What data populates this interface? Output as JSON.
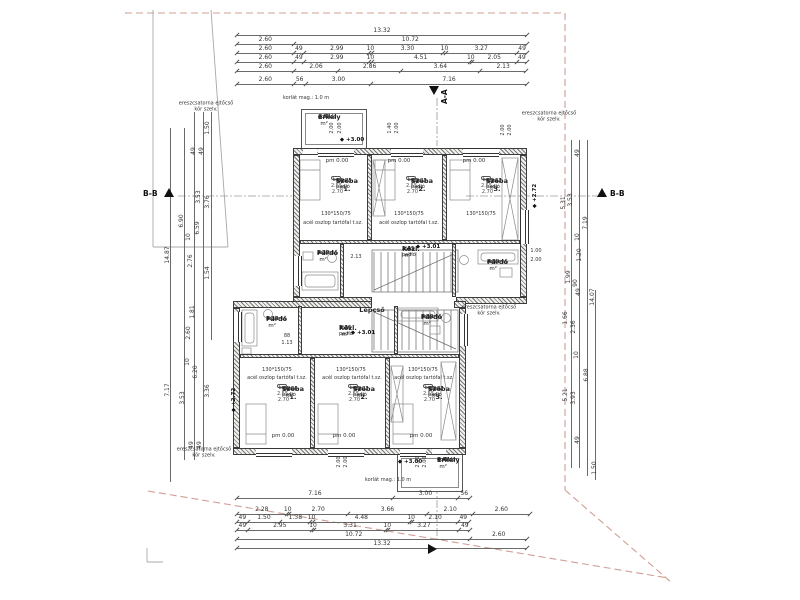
{
  "drawing": {
    "scale_px_per_m": 21.77,
    "line_color": "#555555",
    "boundary_color": "#cf9f94",
    "hatch_color": "#787878"
  },
  "sections": {
    "top": "A-A",
    "left": "B-B",
    "right": "B-B"
  },
  "stair_label": {
    "x": 372,
    "y": 310,
    "t": "Lépcső"
  },
  "pm_label": "pm 0.00",
  "pm_positions": [
    [
      337,
      161
    ],
    [
      399,
      161
    ],
    [
      474,
      161
    ],
    [
      283,
      436
    ],
    [
      344,
      436
    ],
    [
      421,
      436
    ]
  ],
  "levels": [
    {
      "x": 352,
      "y": 140,
      "t": "+3.00"
    },
    {
      "x": 410,
      "y": 462,
      "t": "+3.00"
    },
    {
      "x": 428,
      "y": 247,
      "t": "+3.01"
    },
    {
      "x": 363,
      "y": 333,
      "t": "+3.01"
    },
    {
      "x": 535,
      "y": 196,
      "t": "+2.72",
      "rot": true
    },
    {
      "x": 234,
      "y": 400,
      "t": "+2.72",
      "rot": true
    }
  ],
  "rooms": [
    {
      "id": "A.K3",
      "name": "Erkély",
      "floor": "greslap",
      "area": "4.50 m²",
      "x": 318,
      "y": 114,
      "boxed": false
    },
    {
      "id": "A.12",
      "name": "Szoba 1.",
      "floor": "lam. padló",
      "area": "14.75 m²",
      "extra": "bm: 2.55-2.70",
      "x": 331,
      "y": 176,
      "boxed": true
    },
    {
      "id": "A.13",
      "name": "Szoba 2.",
      "floor": "lam. padló",
      "area": "13.33 m²",
      "extra": "bm: 2.55-2.70",
      "x": 406,
      "y": 176,
      "boxed": true
    },
    {
      "id": "A.14",
      "name": "Szoba 3.",
      "floor": "lam. padló",
      "area": "13.32 m²",
      "extra": "bm: 2.55-2.70",
      "x": 481,
      "y": 176,
      "boxed": true
    },
    {
      "id": "A.16",
      "name": "Fürdő",
      "floor": "kerámia",
      "area": "3.72 m²",
      "x": 317,
      "y": 250,
      "boxed": false
    },
    {
      "id": "A.11",
      "name": "Közl.",
      "floor": "lam. padló",
      "area": "5.43 m²",
      "x": 402,
      "y": 246,
      "boxed": false
    },
    {
      "id": "A.15",
      "name": "Fürdő",
      "floor": "kerámia",
      "area": "4.83 m²",
      "x": 487,
      "y": 259,
      "boxed": false
    },
    {
      "id": "B.16",
      "name": "Fürdő",
      "floor": "kerámia",
      "area": "3.73 m²",
      "x": 266,
      "y": 316,
      "boxed": false
    },
    {
      "id": "B.11",
      "name": "Közl.",
      "floor": "lam. padló",
      "area": "5.36 m²",
      "x": 339,
      "y": 325,
      "boxed": false
    },
    {
      "id": "B.15",
      "name": "Fürdő",
      "floor": "kerámia",
      "area": "4.83 m²",
      "x": 421,
      "y": 314,
      "boxed": false
    },
    {
      "id": "B.12",
      "name": "Szoba 1.",
      "floor": "lam. padló",
      "area": "14.66 m²",
      "extra": "bm: 2.55-2.70",
      "x": 277,
      "y": 384,
      "boxed": true
    },
    {
      "id": "B.13",
      "name": "Szoba 2.",
      "floor": "lam. padló",
      "area": "13.32 m²",
      "extra": "bm: 2.55-2.70",
      "x": 348,
      "y": 384,
      "boxed": true
    },
    {
      "id": "B.14",
      "name": "Szoba 3.",
      "floor": "lam. padló",
      "area": "13.32 m²",
      "extra": "bm: 2.55-2.70",
      "x": 423,
      "y": 384,
      "boxed": true
    },
    {
      "id": "B.K3",
      "name": "Erkély",
      "floor": "greslap",
      "area": "4.47 m²",
      "x": 437,
      "y": 457,
      "boxed": false
    }
  ],
  "dims": {
    "top": {
      "x0": 237,
      "rows": [
        {
          "y": 35,
          "values": [
            "13.32"
          ]
        },
        {
          "y": 44,
          "values": [
            "2.60",
            "10.72"
          ]
        },
        {
          "y": 53,
          "values": [
            "2.60",
            "49",
            "2.99",
            "10",
            "3.30",
            "10",
            "3.27",
            "49"
          ]
        },
        {
          "y": 62,
          "values": [
            "2.60",
            "49",
            "2.99",
            "10",
            "4.51",
            "10",
            "2.05",
            "49"
          ]
        },
        {
          "y": 71,
          "values": [
            "2.60",
            "2.06",
            "2.86",
            "3.64",
            "2.13"
          ]
        },
        {
          "y": 84,
          "values": [
            "2.60",
            "56",
            "3.00",
            "7.16"
          ]
        }
      ]
    },
    "bottom": {
      "x0": 237,
      "rows": [
        {
          "y": 498,
          "values": [
            "7.16",
            "3.00",
            "56"
          ]
        },
        {
          "y": 514,
          "values": [
            "2.28",
            "10",
            "2.70",
            "3.66",
            "2.10",
            "2.60"
          ]
        },
        {
          "y": 522,
          "values": [
            "49",
            "1.50",
            "1.38",
            "10",
            "4.48",
            "10",
            "2.10",
            "49"
          ]
        },
        {
          "y": 530,
          "values": [
            "49",
            "2.95",
            "10",
            "3.31",
            "10",
            "3.27",
            "49"
          ]
        },
        {
          "y": 539,
          "values": [
            "10.72",
            "2.60"
          ]
        },
        {
          "y": 548,
          "values": [
            "13.32"
          ]
        }
      ]
    },
    "left": {
      "vlines": [
        {
          "x": 170,
          "y0": 128,
          "y1": 482
        },
        {
          "x": 184,
          "y0": 128,
          "y1": 460
        },
        {
          "x": 194,
          "y0": 112,
          "y1": 460
        },
        {
          "x": 203,
          "y0": 112,
          "y1": 452
        },
        {
          "x": 211,
          "y0": 112,
          "y1": 340
        }
      ],
      "labels": [
        {
          "x": 208,
          "y": 128,
          "t": "1.50"
        },
        {
          "x": 194,
          "y": 151,
          "t": "49"
        },
        {
          "x": 202,
          "y": 151,
          "t": "49"
        },
        {
          "x": 199,
          "y": 197,
          "t": "3.53"
        },
        {
          "x": 208,
          "y": 202,
          "t": "3.76"
        },
        {
          "x": 182,
          "y": 221,
          "t": "6.90"
        },
        {
          "x": 198,
          "y": 228,
          "t": "6.59"
        },
        {
          "x": 189,
          "y": 237,
          "t": "10"
        },
        {
          "x": 191,
          "y": 261,
          "t": "2.76"
        },
        {
          "x": 208,
          "y": 273,
          "t": "1.54"
        },
        {
          "x": 193,
          "y": 312,
          "t": "1.81"
        },
        {
          "x": 189,
          "y": 333,
          "t": "2.60"
        },
        {
          "x": 168,
          "y": 255,
          "t": "14.87"
        },
        {
          "x": 168,
          "y": 390,
          "t": "7.17"
        },
        {
          "x": 183,
          "y": 398,
          "t": "3.53"
        },
        {
          "x": 196,
          "y": 372,
          "t": "6.20"
        },
        {
          "x": 188,
          "y": 362,
          "t": "10"
        },
        {
          "x": 208,
          "y": 391,
          "t": "3.36"
        },
        {
          "x": 192,
          "y": 445,
          "t": "49"
        },
        {
          "x": 200,
          "y": 445,
          "t": "49"
        }
      ]
    },
    "right": {
      "vlines": [
        {
          "x": 571,
          "y0": 140,
          "y1": 468
        },
        {
          "x": 579,
          "y0": 140,
          "y1": 468
        },
        {
          "x": 587,
          "y0": 140,
          "y1": 476
        },
        {
          "x": 595,
          "y0": 290,
          "y1": 480
        }
      ],
      "labels": [
        {
          "x": 578,
          "y": 153,
          "t": "49"
        },
        {
          "x": 571,
          "y": 200,
          "t": "3.53"
        },
        {
          "x": 564,
          "y": 203,
          "t": "5.31"
        },
        {
          "x": 586,
          "y": 223,
          "t": "7.19"
        },
        {
          "x": 578,
          "y": 237,
          "t": "10"
        },
        {
          "x": 580,
          "y": 255,
          "t": "1.20"
        },
        {
          "x": 569,
          "y": 277,
          "t": "1.99"
        },
        {
          "x": 576,
          "y": 283,
          "t": "90"
        },
        {
          "x": 579,
          "y": 292,
          "t": "49"
        },
        {
          "x": 593,
          "y": 297,
          "t": "14.07"
        },
        {
          "x": 566,
          "y": 318,
          "t": "1.66"
        },
        {
          "x": 574,
          "y": 327,
          "t": "2.36"
        },
        {
          "x": 577,
          "y": 355,
          "t": "10"
        },
        {
          "x": 587,
          "y": 375,
          "t": "6.88"
        },
        {
          "x": 566,
          "y": 395,
          "t": "5.21"
        },
        {
          "x": 574,
          "y": 398,
          "t": "3.93"
        },
        {
          "x": 578,
          "y": 440,
          "t": "49"
        },
        {
          "x": 595,
          "y": 468,
          "t": "1.50"
        }
      ]
    }
  },
  "annotations": [
    {
      "x": 306,
      "y": 99,
      "t": "korlát mag.: 1.0 m"
    },
    {
      "x": 388,
      "y": 481,
      "t": "korlát mag.: 1.0 m"
    },
    {
      "x": 206,
      "y": 107,
      "t": "ereszcsatorna ejtőcső",
      "t2": "kör szelv."
    },
    {
      "x": 549,
      "y": 117,
      "t": "ereszcsatorna ejtőcső",
      "t2": "kör szelv."
    },
    {
      "x": 489,
      "y": 311,
      "t": "ereszcsatorna ejtőcső",
      "t2": "kör szelv."
    },
    {
      "x": 204,
      "y": 453,
      "t": "ereszcsatorna ejtőcső",
      "t2": "kör szelv."
    },
    {
      "x": 333,
      "y": 224,
      "t": "acél oszlop tartófal t.sz."
    },
    {
      "x": 409,
      "y": 224,
      "t": "acél oszlop tartófal t.sz."
    },
    {
      "x": 277,
      "y": 379,
      "t": "acél oszlop tartófal t.sz."
    },
    {
      "x": 352,
      "y": 379,
      "t": "acél oszlop tartófal t.sz."
    },
    {
      "x": 424,
      "y": 379,
      "t": "acél oszlop tartófal t.sz."
    },
    {
      "x": 336,
      "y": 215,
      "t": "130*150/75"
    },
    {
      "x": 409,
      "y": 215,
      "t": "130*150/75"
    },
    {
      "x": 481,
      "y": 215,
      "t": "130*150/75"
    },
    {
      "x": 277,
      "y": 371,
      "t": "130*150/75"
    },
    {
      "x": 351,
      "y": 371,
      "t": "130*150/75"
    },
    {
      "x": 423,
      "y": 371,
      "t": "130*150/75"
    },
    {
      "x": 536,
      "y": 252,
      "t": "1.00"
    },
    {
      "x": 536,
      "y": 261,
      "t": "2.00"
    },
    {
      "x": 287,
      "y": 337,
      "t": "88"
    },
    {
      "x": 287,
      "y": 344,
      "t": "1.13"
    },
    {
      "x": 356,
      "y": 258,
      "t": "2.13"
    },
    {
      "x": 333,
      "y": 128,
      "t": "2.00",
      "rot": true
    },
    {
      "x": 341,
      "y": 128,
      "t": "2.00",
      "rot": true
    },
    {
      "x": 391,
      "y": 128,
      "t": "1.40",
      "rot": true
    },
    {
      "x": 398,
      "y": 128,
      "t": "2.00",
      "rot": true
    },
    {
      "x": 504,
      "y": 130,
      "t": "2.00",
      "rot": true
    },
    {
      "x": 511,
      "y": 130,
      "t": "2.00",
      "rot": true
    },
    {
      "x": 340,
      "y": 462,
      "t": "2.00",
      "rot": true
    },
    {
      "x": 347,
      "y": 462,
      "t": "2.00",
      "rot": true
    },
    {
      "x": 419,
      "y": 462,
      "t": "2.00",
      "rot": true
    },
    {
      "x": 426,
      "y": 462,
      "t": "2.00",
      "rot": true
    }
  ]
}
